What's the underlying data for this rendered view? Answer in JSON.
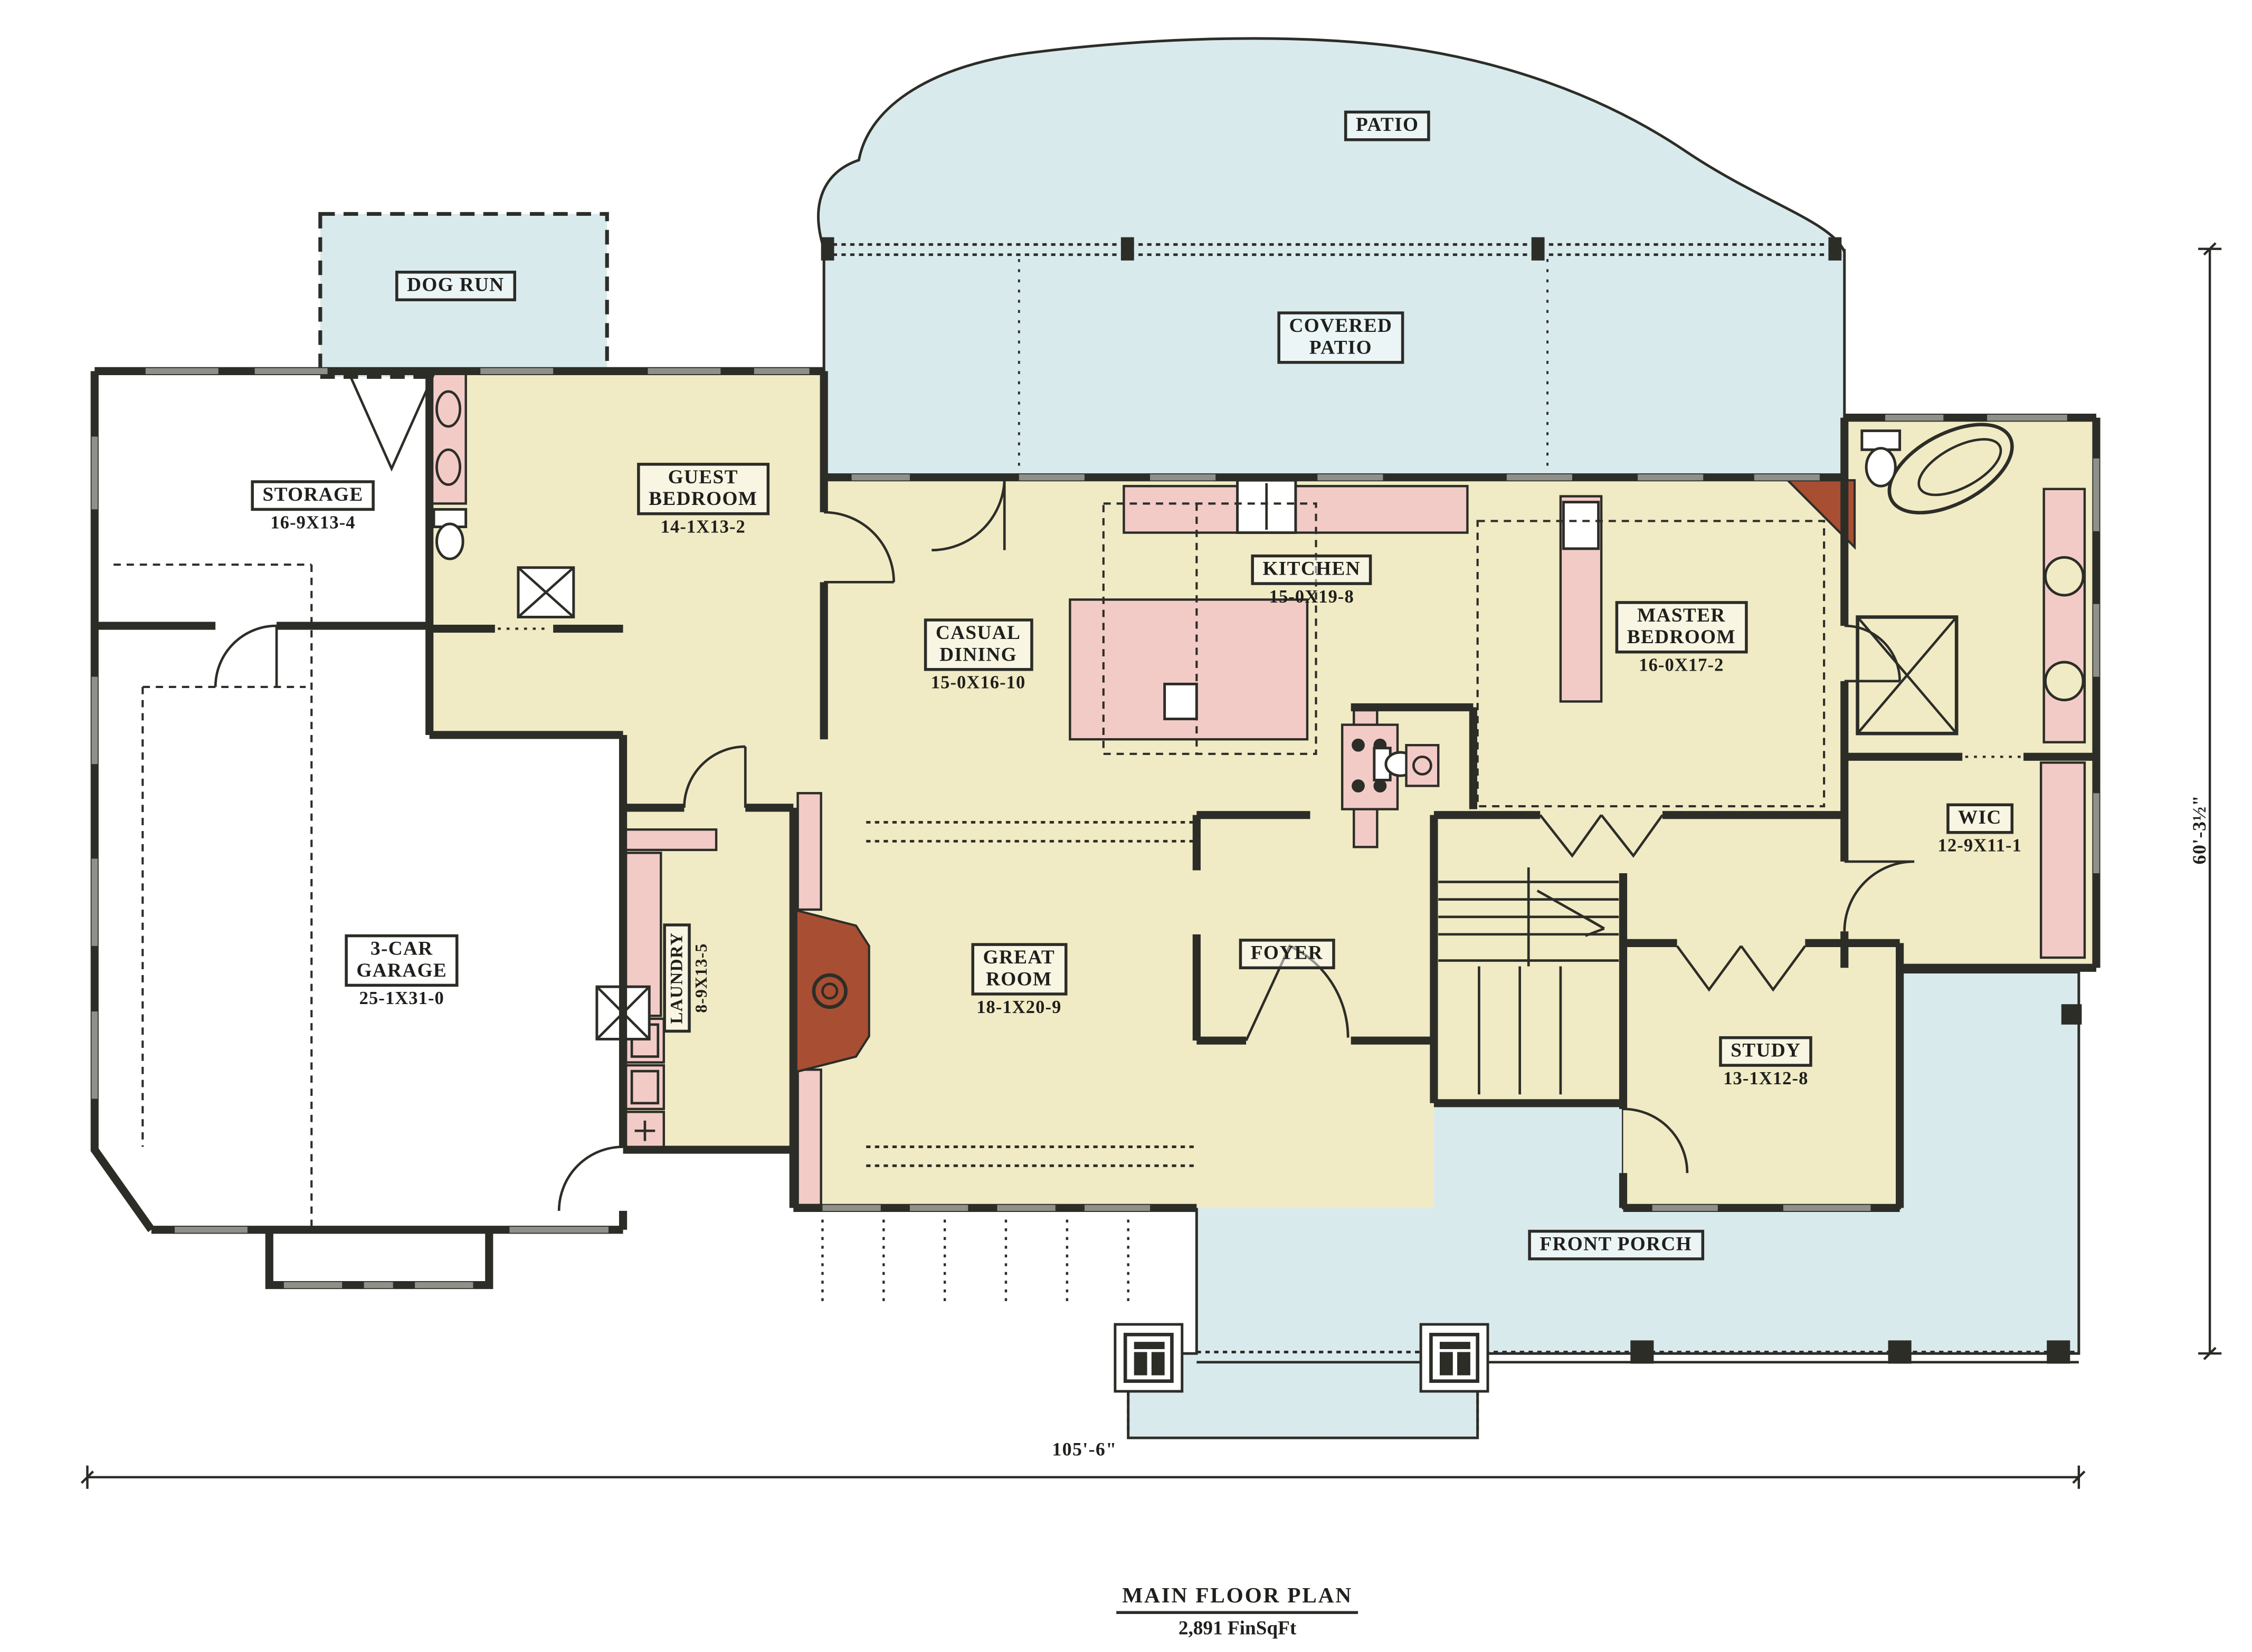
{
  "plan": {
    "title": "MAIN FLOOR PLAN",
    "area": "2,891 FinSqFt",
    "width_label": "105'-6\"",
    "height_label": "60'-3½\""
  },
  "rooms": {
    "patio": {
      "name": "PATIO"
    },
    "dog_run": {
      "name": "DOG RUN"
    },
    "covered_patio": {
      "name": "COVERED\nPATIO"
    },
    "storage": {
      "name": "STORAGE",
      "dims": "16-9X13-4"
    },
    "guest_bedroom": {
      "name": "GUEST\nBEDROOM",
      "dims": "14-1X13-2"
    },
    "kitchen": {
      "name": "KITCHEN",
      "dims": "15-0X19-8"
    },
    "casual_dining": {
      "name": "CASUAL\nDINING",
      "dims": "15-0X16-10"
    },
    "master_bedroom": {
      "name": "MASTER\nBEDROOM",
      "dims": "16-0X17-2"
    },
    "garage": {
      "name": "3-CAR\nGARAGE",
      "dims": "25-1X31-0"
    },
    "laundry": {
      "name": "LAUNDRY",
      "dims": "8-9X13-5"
    },
    "great_room": {
      "name": "GREAT\nROOM",
      "dims": "18-1X20-9"
    },
    "foyer": {
      "name": "FOYER"
    },
    "wic": {
      "name": "WIC",
      "dims": "12-9X11-1"
    },
    "study": {
      "name": "STUDY",
      "dims": "13-1X12-8"
    },
    "front_porch": {
      "name": "FRONT PORCH"
    }
  },
  "colors": {
    "cream": "#f0ebc5",
    "patio": "#d9eaed",
    "pink": "#f2cbc7",
    "rust": "#a84e32",
    "wall": "#2d2d28",
    "wallGray": "#90908a",
    "line": "#2b2b26"
  }
}
